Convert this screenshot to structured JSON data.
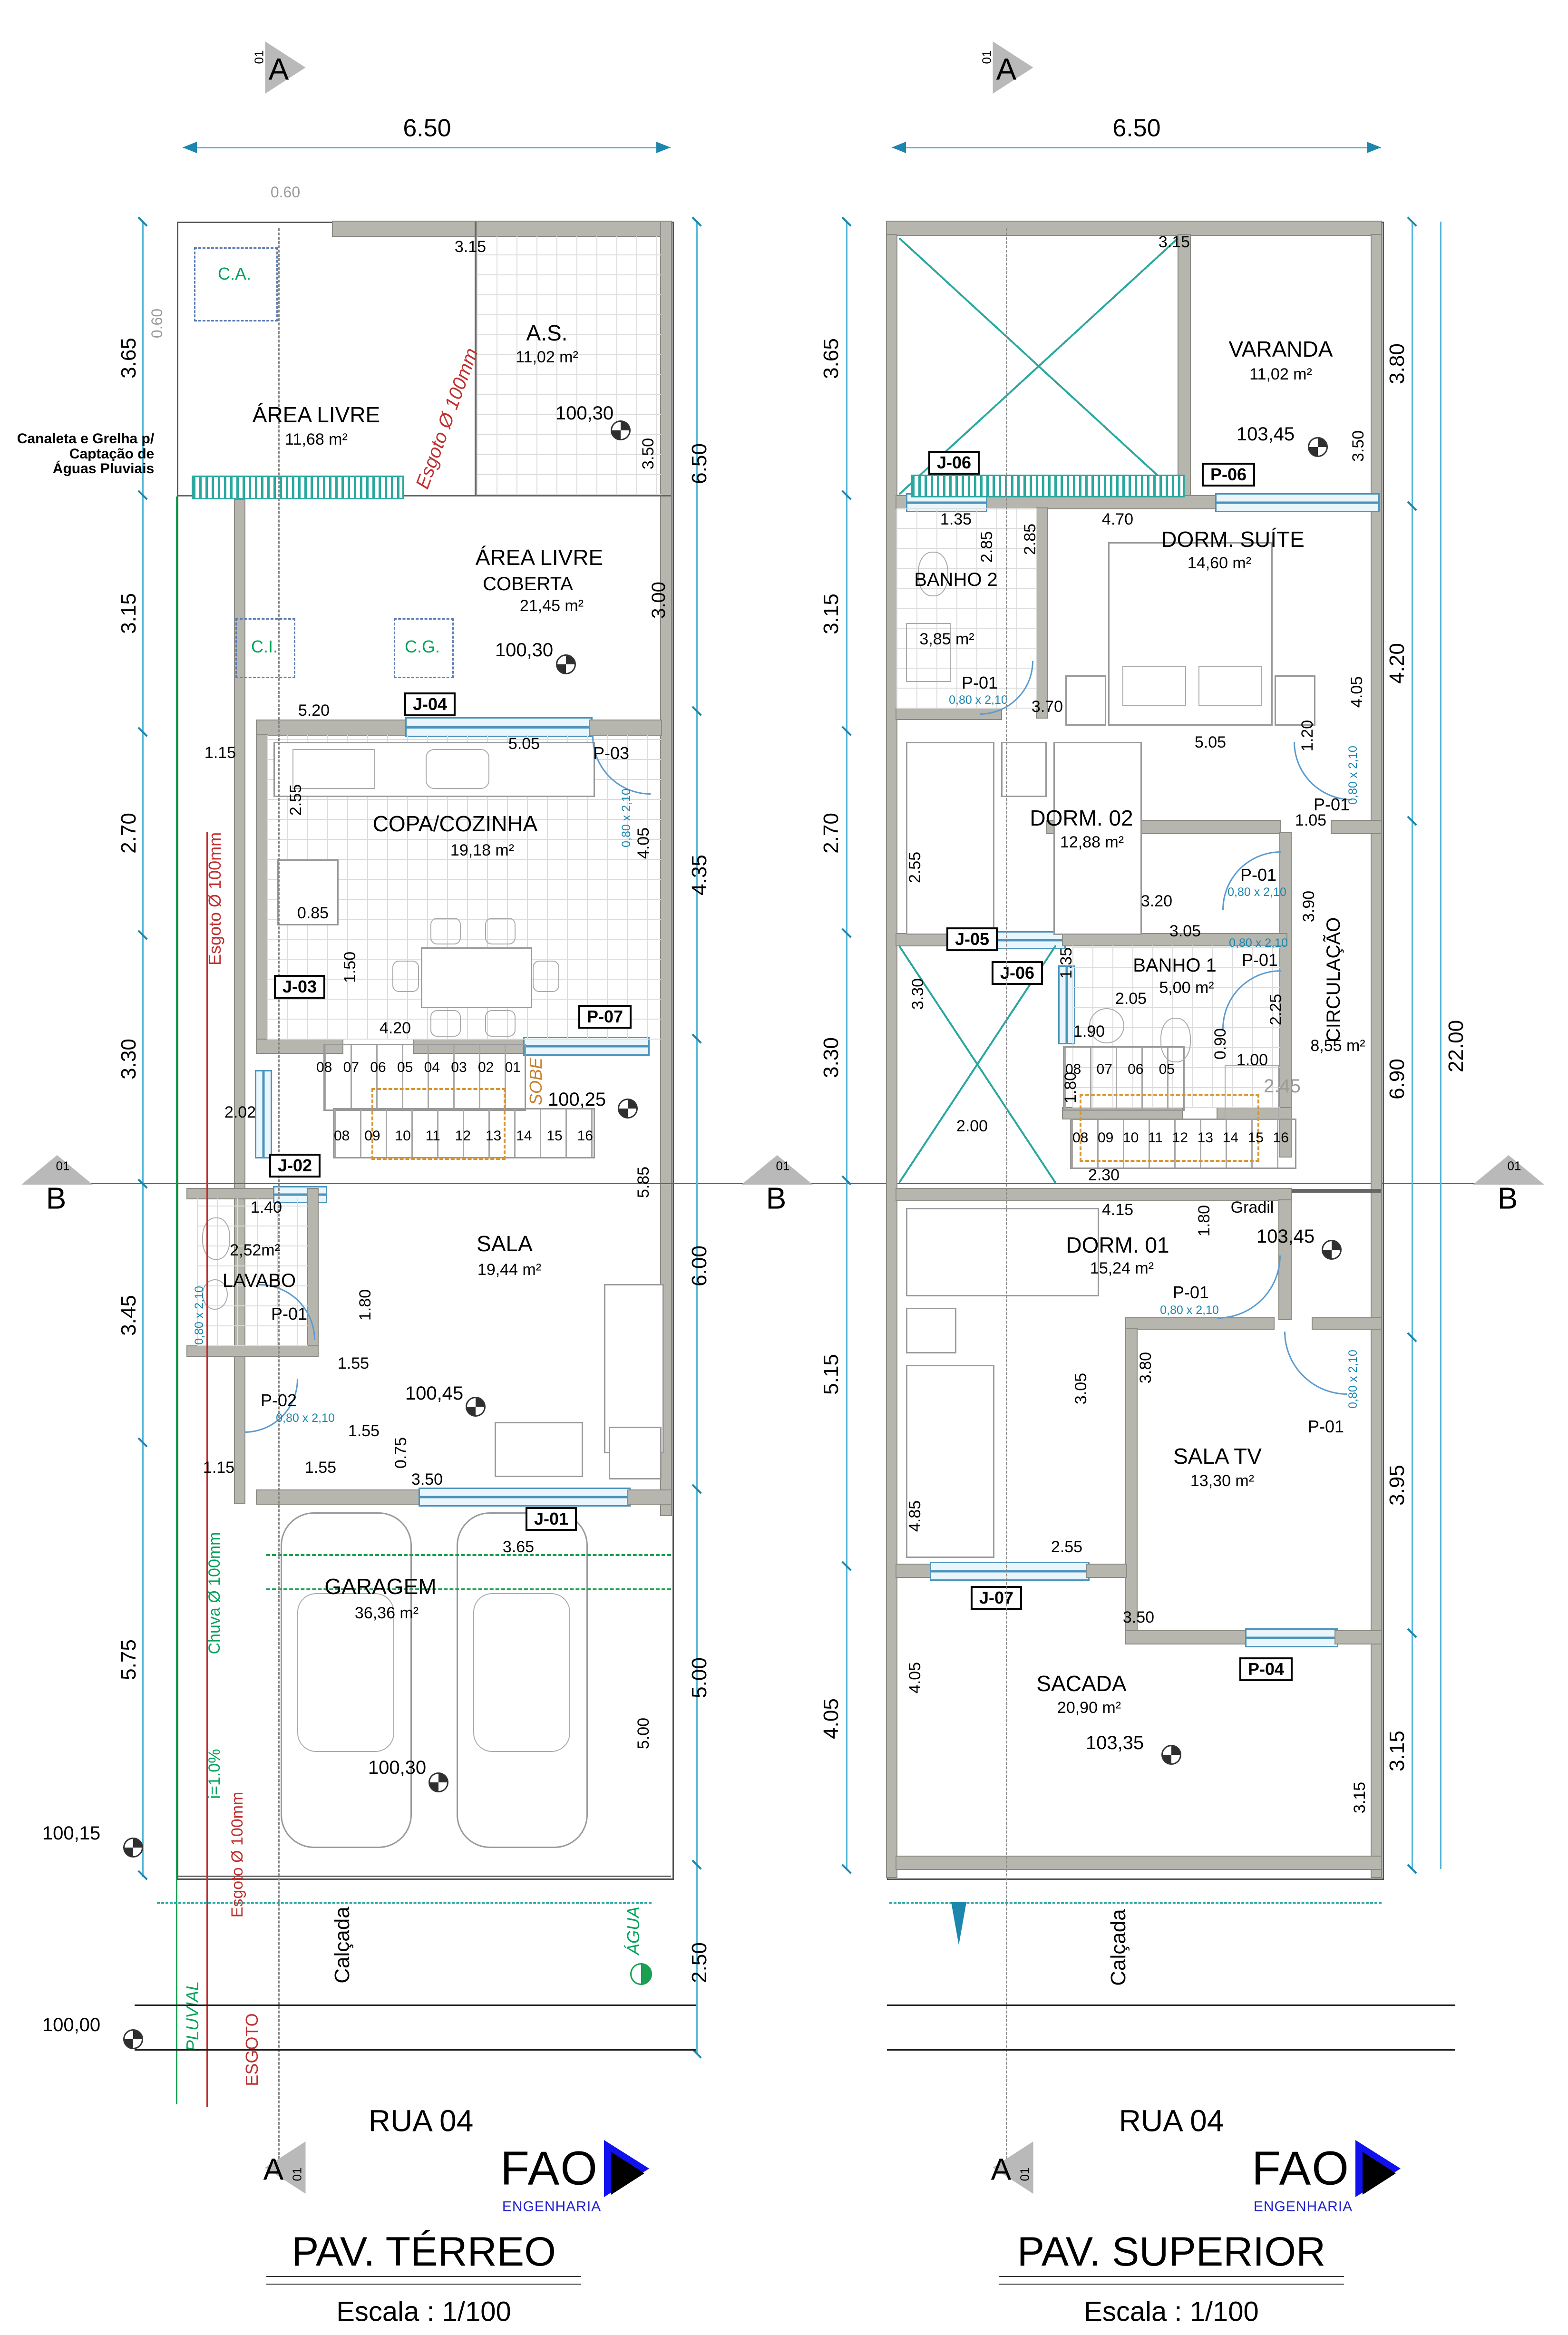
{
  "logo": {
    "name": "FAO",
    "sub": "ENGENHARIA"
  },
  "markers": {
    "section_a": "A",
    "section_b": "B",
    "index": "01"
  },
  "titles": {
    "terreo": "PAV. TÉRREO",
    "superior": "PAV. SUPERIOR",
    "scale": "Escala : 1/100",
    "street": "RUA 04"
  },
  "tags": {
    "p01": "P-01",
    "p02": "P-02",
    "p03": "P-03",
    "p04": "P-04",
    "p06": "P-06",
    "p07": "P-07",
    "j01": "J-01",
    "j02": "J-02",
    "j03": "J-03",
    "j04": "J-04",
    "j05": "J-05",
    "j06": "J-06",
    "j07": "J-07",
    "door_size": "0,80 x 2,10"
  },
  "annotations": {
    "canaleta_l1": "Canaleta e Grelha p/",
    "canaleta_l2": "Captação de",
    "canaleta_l3": "Águas Pluviais",
    "sobe": "SOBE",
    "gradil": "Gradil",
    "calcada": "Calçada",
    "pluvial": "PLUVIAL",
    "esgoto": "ESGOTO",
    "agua": "ÁGUA",
    "esgoto_pipe": "Esgoto Ø 100mm",
    "chuva_pipe": "Chuva Ø 100mm",
    "slope": "i=1.0%"
  },
  "terreo": {
    "rooms": [
      {
        "name": "ÁREA LIVRE",
        "area": "11,68 m²"
      },
      {
        "name": "A.S.",
        "area": "11,02 m²"
      },
      {
        "name": "ÁREA LIVRE",
        "sub": "COBERTA",
        "area": "21,45 m²"
      },
      {
        "name": "COPA/COZINHA",
        "area": "19,18 m²"
      },
      {
        "name": "LAVABO",
        "area": "2,52m²"
      },
      {
        "name": "SALA",
        "area": "19,44 m²"
      },
      {
        "name": "GARAGEM",
        "area": "36,36 m²"
      }
    ],
    "boxes": {
      "ca": "C.A.",
      "ci": "C.I.",
      "cg": "C.G."
    },
    "levels": [
      "100,30",
      "100,30",
      "100,25",
      "100,45",
      "100,30",
      "100,15",
      "100,00"
    ],
    "dims_left": [
      "3.65",
      "3.15",
      "2.70",
      "3.30",
      "3.45",
      "5.75"
    ],
    "dims_right": [
      "6.50",
      "3.00",
      "4.35",
      "6.00",
      "5.00",
      "2.50"
    ],
    "dims_top": [
      "6.50",
      "0.60",
      "0.60"
    ],
    "dims_inner": [
      "3.15",
      "3.50",
      "5.20",
      "1.15",
      "5.05",
      "2.55",
      "4.05",
      "0.85",
      "1.50",
      "4.20",
      "2.02",
      "1.40",
      "1.80",
      "5.85",
      "1.55",
      "1.55",
      "1.55",
      "1.15",
      "0.75",
      "3.50",
      "3.65",
      "5.00"
    ],
    "stair_up": [
      "08",
      "07",
      "06",
      "05",
      "04",
      "03",
      "02",
      "01"
    ],
    "stair_down": [
      "08",
      "09",
      "10",
      "11",
      "12",
      "13",
      "14",
      "15",
      "16"
    ]
  },
  "superior": {
    "rooms": [
      {
        "name": "VARANDA",
        "area": "11,02 m²"
      },
      {
        "name": "BANHO 2",
        "area": "3,85 m²"
      },
      {
        "name": "DORM. SUÍTE",
        "area": "14,60 m²"
      },
      {
        "name": "DORM. 02",
        "area": "12,88 m²"
      },
      {
        "name": "BANHO 1",
        "area": "5,00 m²"
      },
      {
        "name": "CIRCULAÇÃO",
        "area": "8,55 m²"
      },
      {
        "name": "DORM. 01",
        "area": "15,24 m²"
      },
      {
        "name": "SALA TV",
        "area": "13,30 m²"
      },
      {
        "name": "SACADA",
        "area": "20,90 m²"
      }
    ],
    "levels": [
      "103,45",
      "103,45",
      "103,35"
    ],
    "dims_left": [
      "3.65",
      "3.15",
      "2.70",
      "3.30",
      "5.15",
      "4.05"
    ],
    "dims_right": [
      "3.80",
      "4.20",
      "6.90",
      "3.95",
      "3.15",
      "22.00"
    ],
    "dims_top": [
      "6.50"
    ],
    "dims_inner": [
      "3.15",
      "3.50",
      "1.35",
      "2.85",
      "2.85",
      "4.70",
      "3.70",
      "4.05",
      "5.05",
      "1.20",
      "1.05",
      "2.55",
      "3.20",
      "3.90",
      "3.30",
      "3.05",
      "1.35",
      "2.05",
      "0.90",
      "2.25",
      "1.00",
      "1.90",
      "1.80",
      "2.45",
      "2.00",
      "2.30",
      "4.15",
      "1.80",
      "3.05",
      "3.80",
      "4.85",
      "2.55",
      "3.50",
      "4.05",
      "3.15"
    ],
    "stair_up": [
      "08",
      "07",
      "06",
      "05"
    ],
    "stair_down": [
      "08",
      "09",
      "10",
      "11",
      "12",
      "13",
      "14",
      "15",
      "16"
    ]
  }
}
